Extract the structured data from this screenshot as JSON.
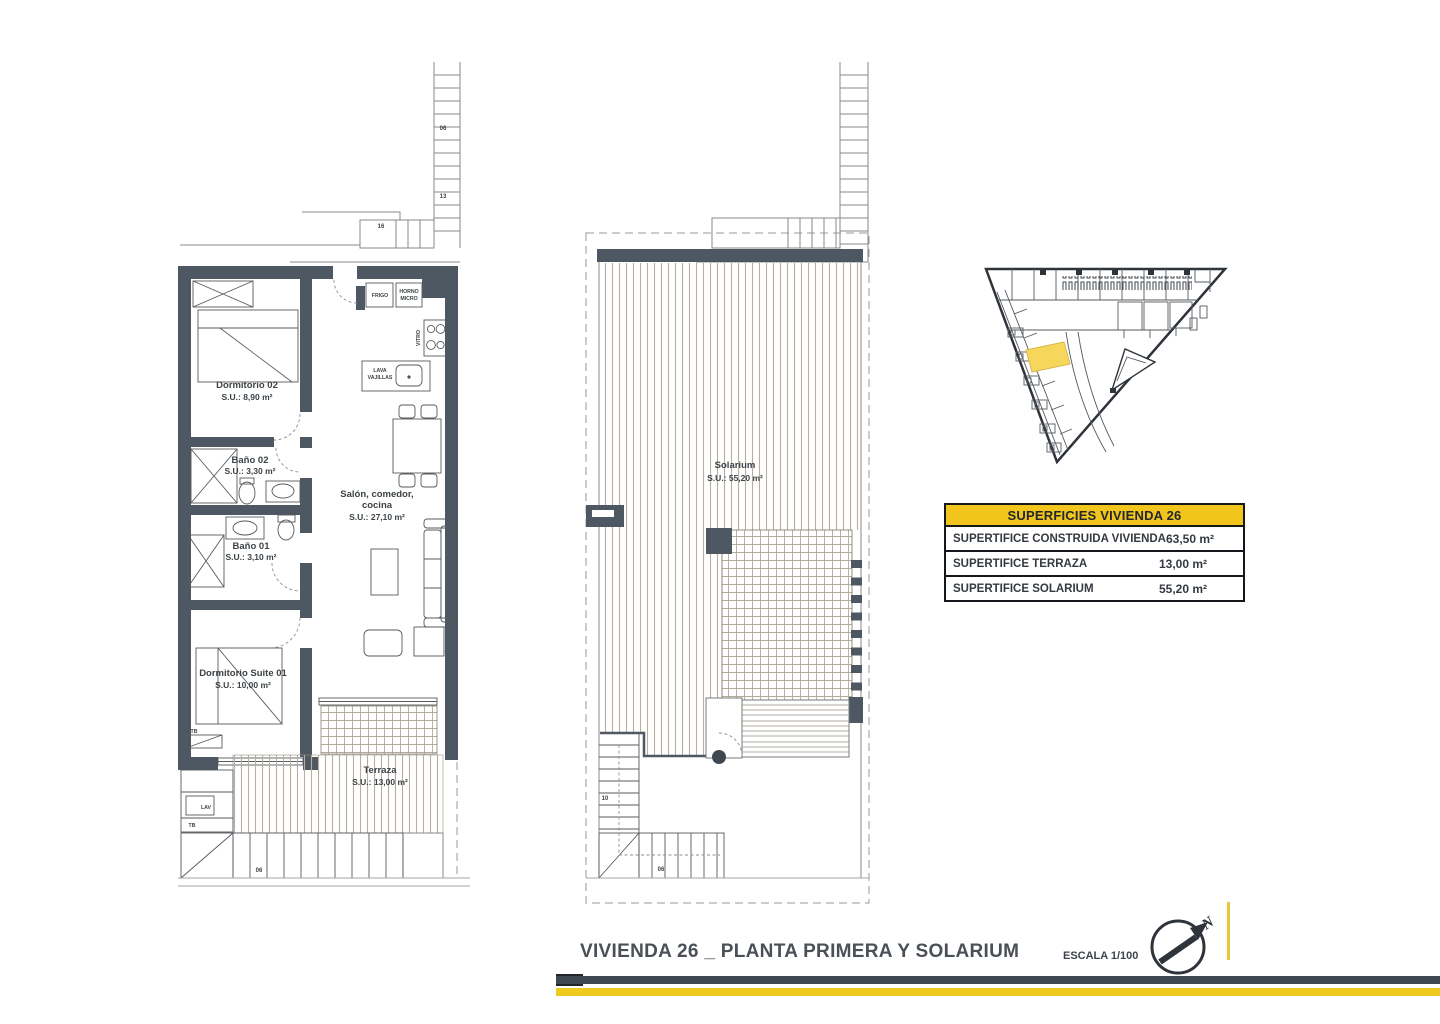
{
  "colors": {
    "wall": "#4e5862",
    "accent_yellow": "#f2c51c",
    "site_highlight": "#f6d75b",
    "bar_dark": "#3d4750",
    "bar_yellow": "#eecb1e",
    "hatch": "#b6ae9f"
  },
  "plan_first": {
    "rooms": [
      {
        "name": "Dormitorio 02",
        "area": "S.U.: 8,90 m²"
      },
      {
        "name": "Baño 02",
        "area": "S.U.: 3,30 m²"
      },
      {
        "name": "Baño 01",
        "area": "S.U.: 3,10 m²"
      },
      {
        "name": "Dormitorio Suite 01",
        "area": "S.U.: 10,00 m²"
      },
      {
        "line1": "Salón, comedor,",
        "line2": "cocina",
        "area": "S.U.: 27,10 m²"
      },
      {
        "name": "Terraza",
        "area": "S.U.: 13,00 m²"
      }
    ],
    "kitchen": {
      "fridge": "FRIGO",
      "oven": [
        "HORNO",
        "MICRO"
      ],
      "hob": "VITRO",
      "sink": [
        "LAVA",
        "VAJILLAS"
      ]
    },
    "utility": {
      "washer": "LAV",
      "cabinet": "TB"
    },
    "stair_numbers": [
      "06",
      "13",
      "16",
      "06"
    ]
  },
  "plan_solarium": {
    "room": {
      "name": "Solarium",
      "area": "S.U.: 55,20 m²"
    },
    "stair_numbers": [
      "10",
      "06"
    ]
  },
  "areas_table": {
    "header": "SUPERFICIES VIVIENDA 26",
    "rows": [
      {
        "label": "SUPERTIFICE CONSTRUIDA VIVIENDA",
        "value": "63,50 m²"
      },
      {
        "label": "SUPERTIFICE TERRAZA",
        "value": "13,00 m²"
      },
      {
        "label": "SUPERTIFICE SOLARIUM",
        "value": "55,20 m²"
      }
    ]
  },
  "footer": {
    "title": "VIVIENDA 26 _ PLANTA PRIMERA Y SOLARIUM",
    "scale": "ESCALA 1/100",
    "north_label": "N"
  }
}
